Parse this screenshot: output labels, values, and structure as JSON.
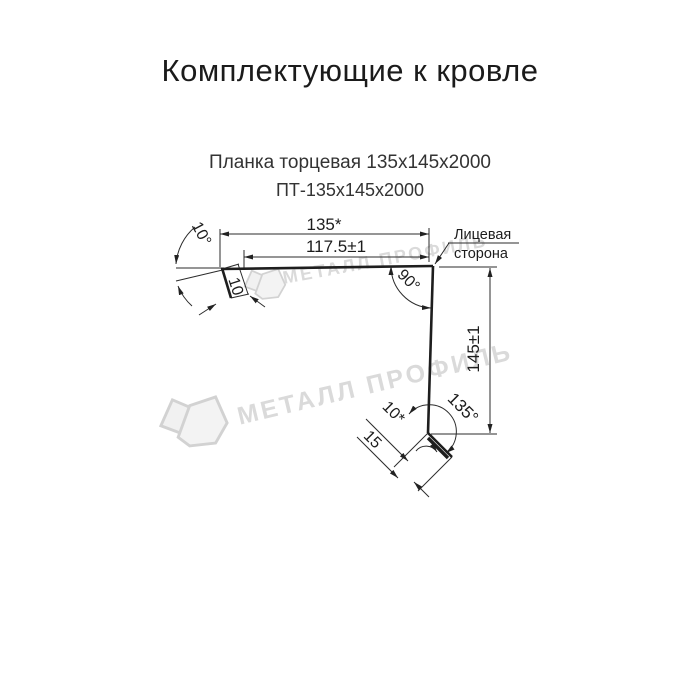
{
  "title": "Комплектующие к кровле",
  "subtitle": "Планка торцевая 135х145х2000",
  "product_code": "ПТ-135х145х2000",
  "drawing": {
    "dim_width_total": "135*",
    "dim_width_face": "117.5±1",
    "dim_height": "145±1",
    "angle_top": "10°",
    "angle_corner": "90°",
    "angle_bottom": "135°",
    "hem_top_length": "10",
    "foot_hem_length": "10*",
    "foot_length": "15",
    "face_label_line1": "Лицевая",
    "face_label_line2": "сторона"
  },
  "watermark": {
    "text": "МЕТАЛЛ ПРОФИЛЬ",
    "color": "#dadada"
  },
  "colors": {
    "line": "#1e1e1e",
    "text": "#1c1c1c",
    "background": "#ffffff"
  }
}
